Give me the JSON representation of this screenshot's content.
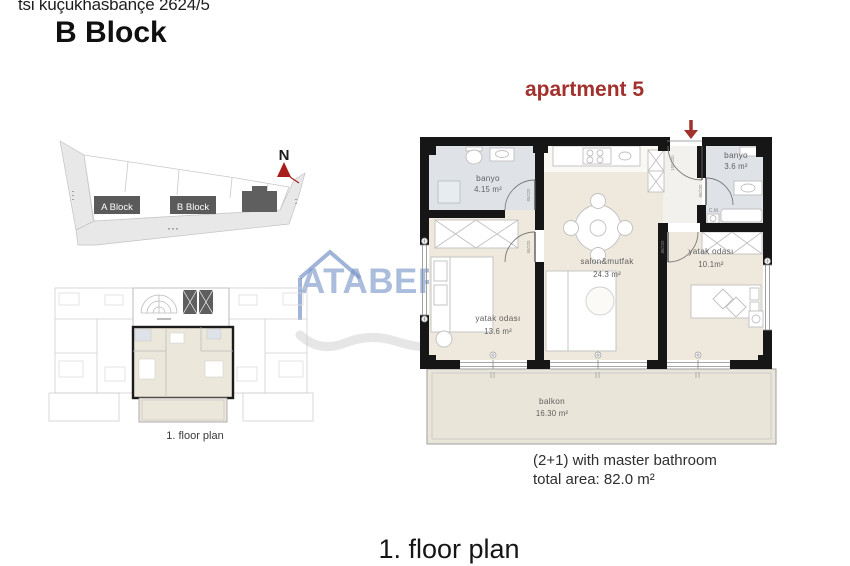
{
  "header": {
    "project_line": "tsi küçükhasbançe 2624/5",
    "block_title": "B Block"
  },
  "site_plan": {
    "block_a_label": "A Block",
    "block_b_label": "B Block",
    "north_label": "N"
  },
  "watermark": {
    "brand": "ATABERK"
  },
  "apartment": {
    "title": "apartment 5",
    "rooms": {
      "banyo1": {
        "name": "banyo",
        "area": "4.15 m²"
      },
      "banyo2": {
        "name": "banyo",
        "area": "3.6 m²"
      },
      "salon": {
        "name": "salon&mutfak",
        "area": "24.3 m²"
      },
      "bedroom1": {
        "name": "yatak odası",
        "area": "13.6 m²"
      },
      "bedroom2": {
        "name": "yatak odası",
        "area": "10.1m²"
      },
      "balcony": {
        "name": "balkon",
        "area": "16.30 m²"
      }
    },
    "door_sizes": {
      "entry": "100/220",
      "banyo1": "80/220",
      "bedroom1": "90/220",
      "banyo2": "80/220",
      "bedroom2": "80/220"
    },
    "labels": {
      "washer": "C.M."
    },
    "summary_line1": "(2+1) with master bathroom",
    "summary_line2": "total area: 82.0 m²"
  },
  "small_plan": {
    "caption": "1. floor plan"
  },
  "footer": {
    "title": "1. floor plan"
  },
  "colors": {
    "accent_red": "#a2312d",
    "watermark_blue": "#7894c6",
    "wall_black": "#161616",
    "floor_beige": "#efe9dd",
    "floor_bath": "#dfe3e8",
    "floor_balcony": "#e9e5d9",
    "site_road_gray": "#e8e8e8",
    "block_dark": "#5a5a5a"
  }
}
